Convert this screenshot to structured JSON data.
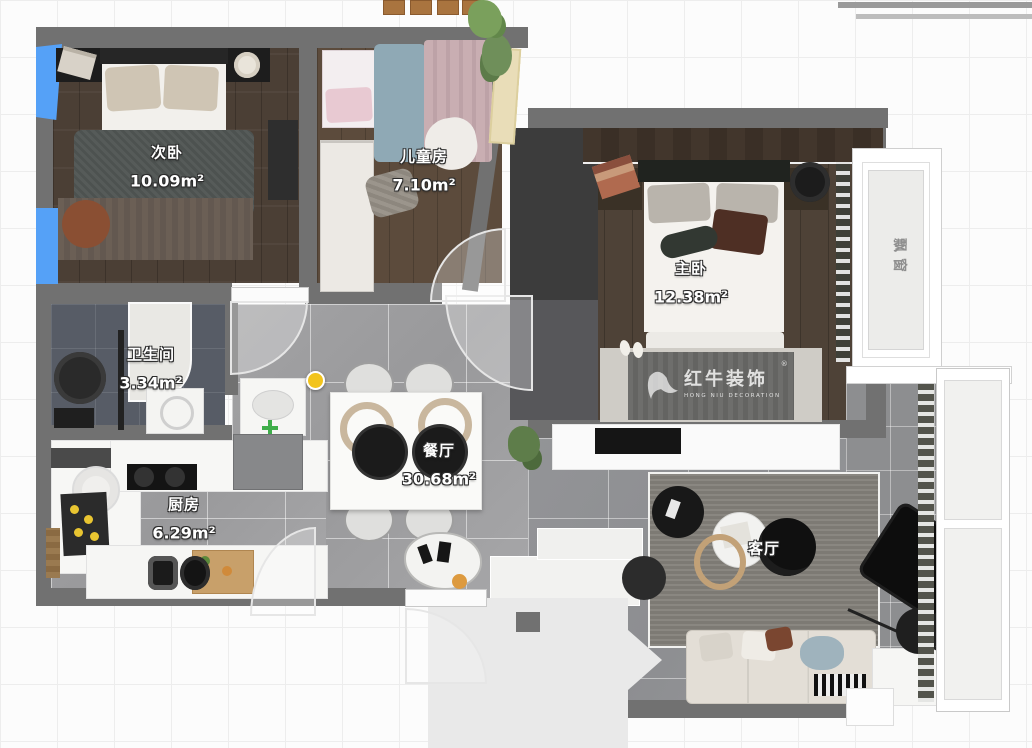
{
  "rooms": [
    {
      "name": "次卧",
      "area": "10.09m²"
    },
    {
      "name": "儿童房",
      "area": "7.10m²"
    },
    {
      "name": "主卧",
      "area": "12.38m²"
    },
    {
      "name": "卫生间",
      "area": "3.34m²"
    },
    {
      "name": "厨房",
      "area": "6.29m²"
    },
    {
      "name": "餐厅",
      "area": "30.68m²"
    },
    {
      "name": "客厅",
      "area": ""
    }
  ],
  "annotations": {
    "bay_window": "飘窗"
  },
  "watermark": {
    "brand": "红牛装饰",
    "subtitle": "HONG NIU DECORATION",
    "registered": "®"
  },
  "colors": {
    "selected_window": "#55a1f7",
    "wall": "#717171",
    "marker_yellow": "#f2c41d",
    "marker_green": "#3fae4a"
  }
}
